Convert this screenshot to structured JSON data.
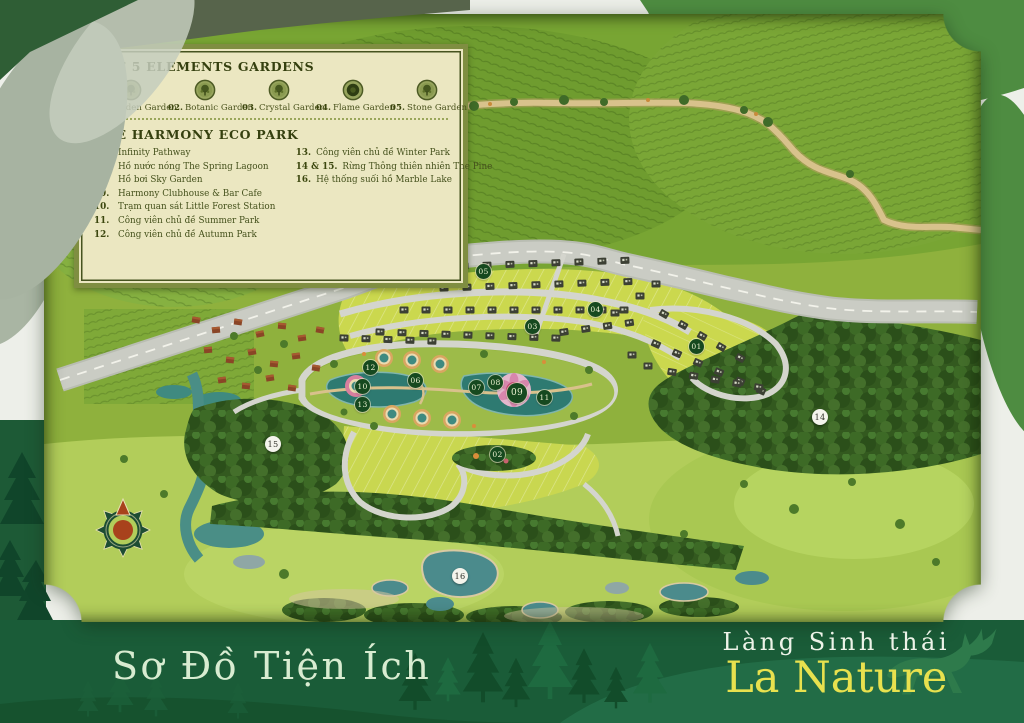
{
  "legend": {
    "gardens_title": "THE 5 ELEMENTS GARDENS",
    "gardens": [
      {
        "num": "01.",
        "label": "Golden Garden"
      },
      {
        "num": "02.",
        "label": "Botanic Garden"
      },
      {
        "num": "03.",
        "label": "Crystal Garden"
      },
      {
        "num": "04.",
        "label": "Flame Garden"
      },
      {
        "num": "05.",
        "label": "Stone Garden"
      }
    ],
    "ecopark_title": "THE HARMONY ECO PARK",
    "ecopark_left": [
      {
        "num": "06.",
        "label": "Infinity Pathway"
      },
      {
        "num": "07.",
        "label": "Hồ nước nóng The Spring Lagoon"
      },
      {
        "num": "08.",
        "label": "Hồ bơi Sky Garden"
      },
      {
        "num": "09.",
        "label": "Harmony Clubhouse & Bar Cafe"
      },
      {
        "num": "10.",
        "label": "Trạm quan sát Little Forest Station"
      },
      {
        "num": "11.",
        "label": "Công viên chủ đề Summer Park"
      },
      {
        "num": "12.",
        "label": "Công viên chủ đề Autumn Park"
      }
    ],
    "ecopark_right": [
      {
        "num": "13.",
        "label": "Công viên chủ đề Winter Park"
      },
      {
        "num": "14 & 15.",
        "label": "Rừng Thông thiên nhiên The Pine"
      },
      {
        "num": "16.",
        "label": "Hệ thống suối hồ Marble Lake"
      }
    ]
  },
  "map": {
    "markers": [
      {
        "label": "01"
      },
      {
        "label": "02"
      },
      {
        "label": "03"
      },
      {
        "label": "04"
      },
      {
        "label": "05"
      },
      {
        "label": "06"
      },
      {
        "label": "07"
      },
      {
        "label": "08"
      },
      {
        "label": "09"
      },
      {
        "label": "10"
      },
      {
        "label": "11"
      },
      {
        "label": "12"
      },
      {
        "label": "13"
      },
      {
        "label": "14"
      },
      {
        "label": "15"
      },
      {
        "label": "16"
      }
    ]
  },
  "footer": {
    "title": "Sơ Đồ Tiện Ích",
    "brand_top": "Làng Sinh thái",
    "brand_name": "La Nature"
  },
  "colors": {
    "band_green": "#1a5c38",
    "brand_yellow": "#e8e14e",
    "legend_cream": "#ebe7c1",
    "legend_frame": "#7f8e41",
    "marker_dark": "#16491f",
    "map_grass": "#8fb13d",
    "lake_teal": "#3f8a80",
    "road_gray": "#caccc4"
  }
}
